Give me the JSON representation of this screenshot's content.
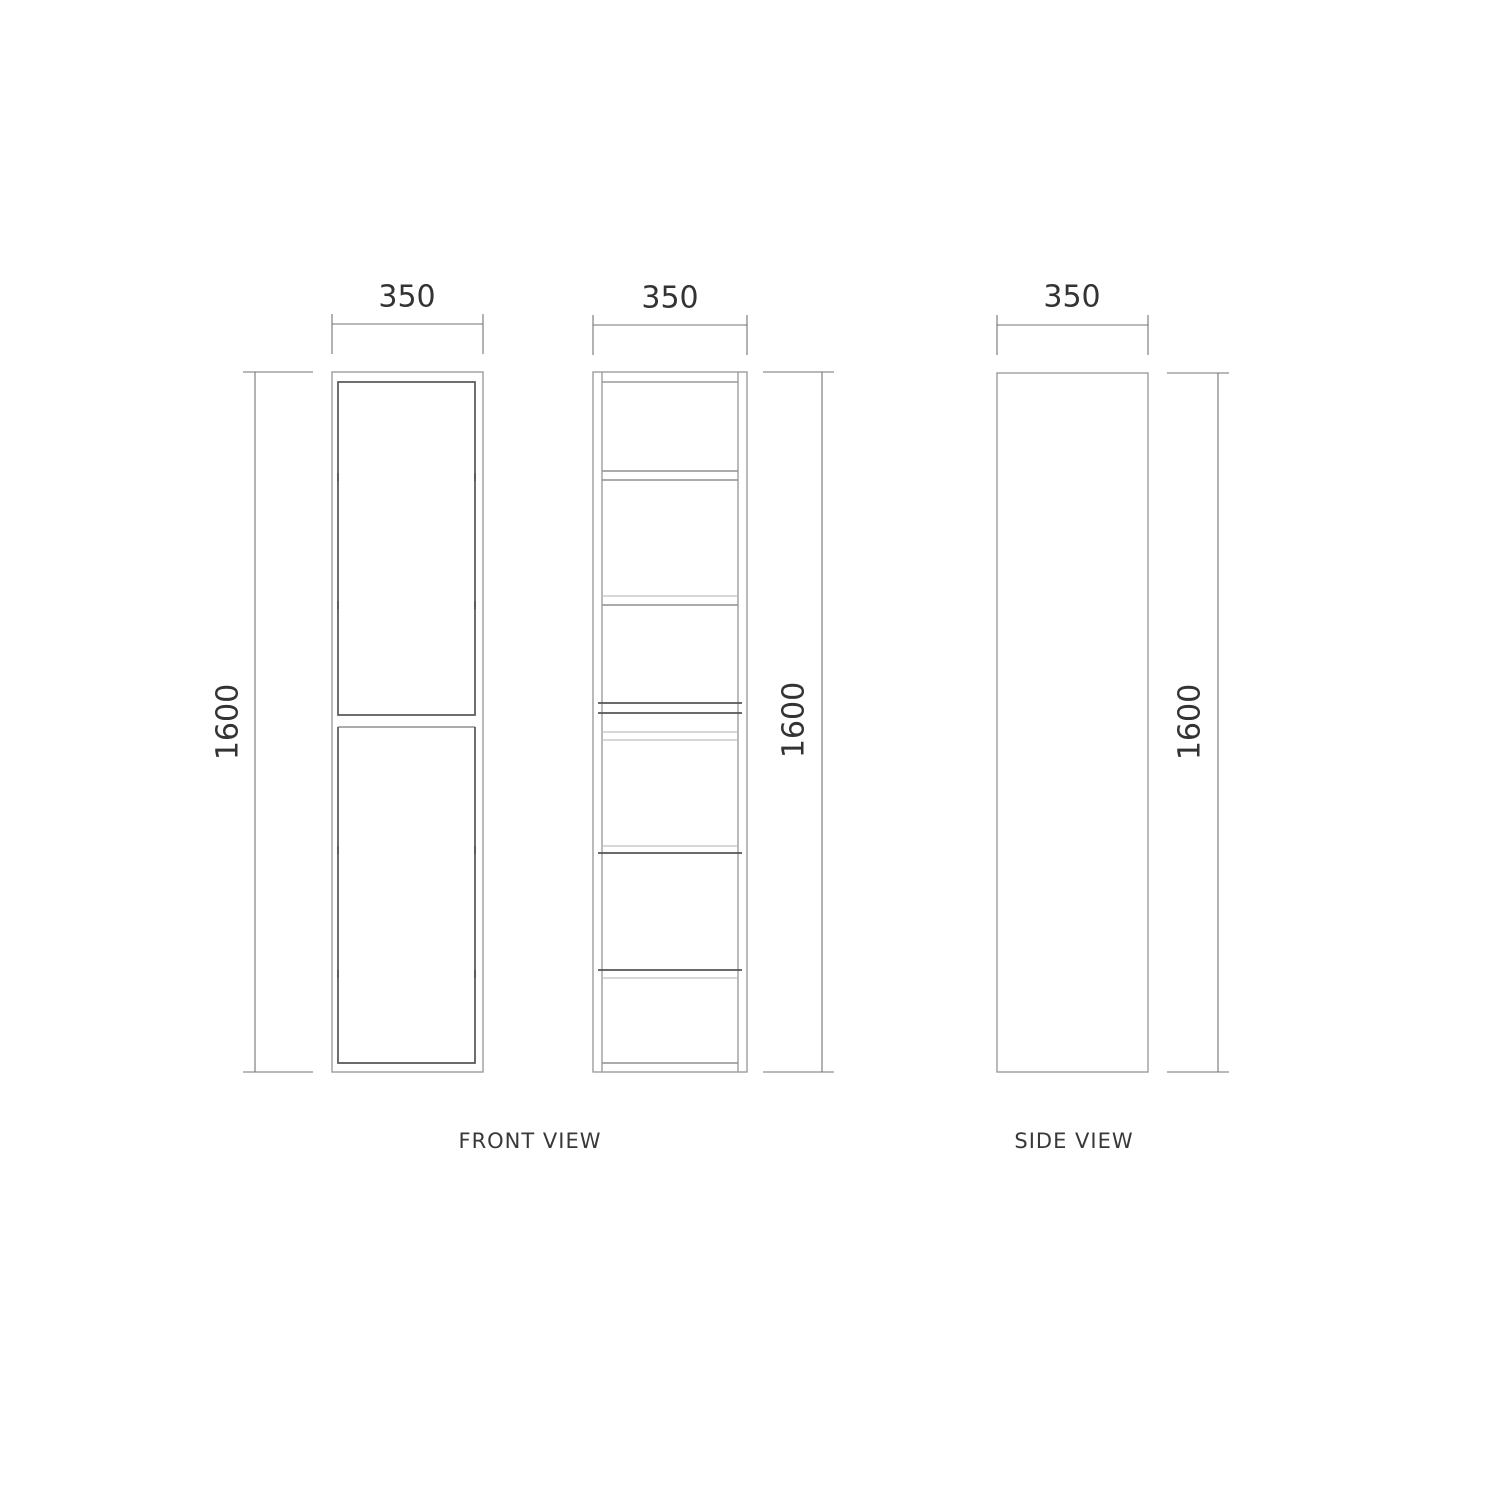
{
  "captions": {
    "front": "FRONT VIEW",
    "side": "SIDE VIEW"
  },
  "views": {
    "front_door": {
      "width_label": "350",
      "height_label": "1600"
    },
    "front_open": {
      "width_label": "350",
      "height_label": "1600"
    },
    "side": {
      "width_label": "350",
      "height_label": "1600"
    }
  },
  "colors": {
    "background": "#ffffff",
    "outline": "#9c9c9c",
    "panel_line": "#555555",
    "dimension_line": "#737373",
    "text": "#333333"
  }
}
